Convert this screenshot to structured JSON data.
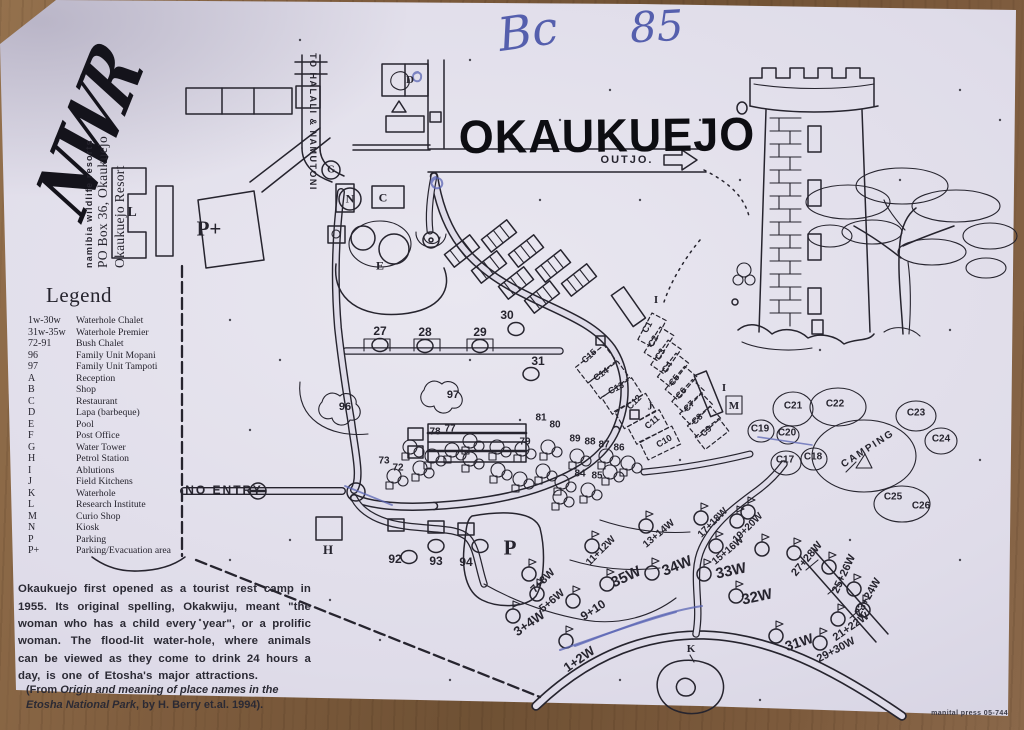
{
  "annotations": {
    "code_left": "Bc",
    "code_right": "85"
  },
  "header": {
    "title": "OKAUKUEJO"
  },
  "branding": {
    "logo": "NWR",
    "org": "namibia wildlife resorts",
    "address": "PO Box 36, Okaukuejo",
    "resort": "Okaukuejo Resort"
  },
  "legend": {
    "title": "Legend",
    "items": [
      {
        "key": "1w-30w",
        "label": "Waterhole Chalet"
      },
      {
        "key": "31w-35w",
        "label": "Waterhole Premier"
      },
      {
        "key": "72-91",
        "label": "Bush Chalet"
      },
      {
        "key": "96",
        "label": "Family Unit Mopani"
      },
      {
        "key": "97",
        "label": "Family Unit Tampoti"
      },
      {
        "key": "A",
        "label": "Reception"
      },
      {
        "key": "B",
        "label": "Shop"
      },
      {
        "key": "C",
        "label": "Restaurant"
      },
      {
        "key": "D",
        "label": "Lapa (barbeque)"
      },
      {
        "key": "E",
        "label": "Pool"
      },
      {
        "key": "F",
        "label": "Post Office"
      },
      {
        "key": "G",
        "label": "Water Tower"
      },
      {
        "key": "H",
        "label": "Petrol Station"
      },
      {
        "key": "I",
        "label": "Ablutions"
      },
      {
        "key": "J",
        "label": "Field Kitchens"
      },
      {
        "key": "K",
        "label": "Waterhole"
      },
      {
        "key": "L",
        "label": "Research Institute"
      },
      {
        "key": "M",
        "label": "Curio Shop"
      },
      {
        "key": "N",
        "label": "Kiosk"
      },
      {
        "key": "P",
        "label": "Parking"
      },
      {
        "key": "P+",
        "label": "Parking/Evacuation area"
      }
    ]
  },
  "map": {
    "outjo_label": "OUTJO.",
    "halali_label": "TO HALALI & NAMUTONI",
    "no_entry_label": "NO ENTRY",
    "labels": [
      {
        "t": "L",
        "x": 132,
        "y": 213,
        "s": 14,
        "f": "ser"
      },
      {
        "t": "P+",
        "x": 209,
        "y": 229,
        "s": 21,
        "f": "ser"
      },
      {
        "t": "N",
        "x": 350,
        "y": 199,
        "s": 12,
        "f": "ser",
        "ring": 11
      },
      {
        "t": "C",
        "x": 383,
        "y": 198,
        "s": 12,
        "f": "ser"
      },
      {
        "t": "E",
        "x": 380,
        "y": 266,
        "s": 12,
        "f": "ser"
      },
      {
        "t": "D",
        "x": 410,
        "y": 80,
        "s": 11,
        "f": "ser"
      },
      {
        "t": "G",
        "x": 331,
        "y": 170,
        "s": 10,
        "f": "ser",
        "ring": 9
      },
      {
        "t": "H",
        "x": 328,
        "y": 550,
        "s": 13,
        "f": "ser"
      },
      {
        "t": "P",
        "x": 510,
        "y": 548,
        "s": 21,
        "f": "ser"
      },
      {
        "t": "K",
        "x": 691,
        "y": 649,
        "s": 11,
        "f": "ser"
      },
      {
        "t": "M",
        "x": 734,
        "y": 406,
        "s": 11,
        "f": "ser"
      },
      {
        "t": "I",
        "x": 656,
        "y": 300,
        "s": 11,
        "f": "ser"
      },
      {
        "t": "I",
        "x": 724,
        "y": 388,
        "s": 11,
        "f": "ser"
      },
      {
        "t": "J",
        "x": 650,
        "y": 407,
        "s": 10,
        "f": "ser"
      },
      {
        "t": "27",
        "x": 380,
        "y": 331,
        "s": 12,
        "dot": [
          0,
          14
        ]
      },
      {
        "t": "28",
        "x": 425,
        "y": 332,
        "s": 12,
        "dot": [
          0,
          14
        ]
      },
      {
        "t": "29",
        "x": 480,
        "y": 332,
        "s": 12,
        "dot": [
          0,
          14
        ]
      },
      {
        "t": "30",
        "x": 507,
        "y": 315,
        "s": 12,
        "dot": [
          9,
          14
        ]
      },
      {
        "t": "31",
        "x": 538,
        "y": 361,
        "s": 12,
        "dot": [
          -7,
          13
        ]
      },
      {
        "t": "96",
        "x": 345,
        "y": 407,
        "s": 11
      },
      {
        "t": "97",
        "x": 453,
        "y": 395,
        "s": 11
      },
      {
        "t": "72",
        "x": 398,
        "y": 468,
        "s": 10
      },
      {
        "t": "73",
        "x": 384,
        "y": 461,
        "s": 10
      },
      {
        "t": "77",
        "x": 450,
        "y": 429,
        "s": 10
      },
      {
        "t": "78",
        "x": 435,
        "y": 432,
        "s": 10
      },
      {
        "t": "79",
        "x": 525,
        "y": 442,
        "s": 10
      },
      {
        "t": "80",
        "x": 555,
        "y": 425,
        "s": 10
      },
      {
        "t": "81",
        "x": 541,
        "y": 418,
        "s": 10
      },
      {
        "t": "84",
        "x": 580,
        "y": 474,
        "s": 10
      },
      {
        "t": "85",
        "x": 597,
        "y": 476,
        "s": 10
      },
      {
        "t": "86",
        "x": 619,
        "y": 448,
        "s": 10
      },
      {
        "t": "87",
        "x": 604,
        "y": 445,
        "s": 10
      },
      {
        "t": "88",
        "x": 590,
        "y": 442,
        "s": 10
      },
      {
        "t": "89",
        "x": 575,
        "y": 439,
        "s": 10
      },
      {
        "t": "92",
        "x": 395,
        "y": 559,
        "s": 12,
        "dot": [
          14,
          -2
        ]
      },
      {
        "t": "93",
        "x": 436,
        "y": 561,
        "s": 12,
        "dot": [
          0,
          -15
        ]
      },
      {
        "t": "94",
        "x": 466,
        "y": 562,
        "s": 12,
        "dot": [
          14,
          -16
        ]
      },
      {
        "t": "C1",
        "x": 647,
        "y": 327,
        "s": 9,
        "r": -60
      },
      {
        "t": "C2",
        "x": 653,
        "y": 341,
        "s": 9,
        "r": -60
      },
      {
        "t": "C3",
        "x": 660,
        "y": 354,
        "s": 9,
        "r": -58
      },
      {
        "t": "C4",
        "x": 667,
        "y": 367,
        "s": 9,
        "r": -55
      },
      {
        "t": "C5",
        "x": 674,
        "y": 380,
        "s": 9,
        "r": -52
      },
      {
        "t": "C6",
        "x": 681,
        "y": 393,
        "s": 9,
        "r": -49
      },
      {
        "t": "C7",
        "x": 689,
        "y": 406,
        "s": 9,
        "r": -46
      },
      {
        "t": "C8",
        "x": 697,
        "y": 419,
        "s": 9,
        "r": -44
      },
      {
        "t": "C9",
        "x": 706,
        "y": 431,
        "s": 9,
        "r": -42
      },
      {
        "t": "C10",
        "x": 664,
        "y": 441,
        "s": 9,
        "r": -30
      },
      {
        "t": "C11",
        "x": 652,
        "y": 422,
        "s": 9,
        "r": -40
      },
      {
        "t": "C12",
        "x": 634,
        "y": 402,
        "s": 9,
        "r": -45
      },
      {
        "t": "C13",
        "x": 616,
        "y": 388,
        "s": 9,
        "r": -28
      },
      {
        "t": "C14",
        "x": 601,
        "y": 374,
        "s": 9,
        "r": -35
      },
      {
        "t": "C15",
        "x": 589,
        "y": 356,
        "s": 9,
        "r": -42
      },
      {
        "t": "C17",
        "x": 785,
        "y": 460,
        "s": 10
      },
      {
        "t": "C18",
        "x": 813,
        "y": 457,
        "s": 10
      },
      {
        "t": "C19",
        "x": 760,
        "y": 429,
        "s": 10
      },
      {
        "t": "C20",
        "x": 787,
        "y": 433,
        "s": 10
      },
      {
        "t": "C21",
        "x": 793,
        "y": 406,
        "s": 10
      },
      {
        "t": "C22",
        "x": 835,
        "y": 404,
        "s": 10
      },
      {
        "t": "C23",
        "x": 916,
        "y": 413,
        "s": 10
      },
      {
        "t": "C24",
        "x": 941,
        "y": 439,
        "s": 10
      },
      {
        "t": "C25",
        "x": 893,
        "y": 497,
        "s": 10
      },
      {
        "t": "C26",
        "x": 921,
        "y": 506,
        "s": 10
      },
      {
        "t": "CAMPING",
        "x": 868,
        "y": 449,
        "s": 10,
        "r": -33,
        "sp": 2
      },
      {
        "t": "35W",
        "x": 626,
        "y": 577,
        "s": 15,
        "r": -25
      },
      {
        "t": "34W",
        "x": 677,
        "y": 566,
        "s": 15,
        "r": -22
      },
      {
        "t": "33W",
        "x": 731,
        "y": 571,
        "s": 15,
        "r": -12
      },
      {
        "t": "32W",
        "x": 757,
        "y": 597,
        "s": 15,
        "r": -12
      },
      {
        "t": "31W",
        "x": 799,
        "y": 642,
        "s": 14,
        "r": -18
      },
      {
        "t": "1+2W",
        "x": 579,
        "y": 659,
        "s": 13,
        "r": -35
      },
      {
        "t": "3+4W",
        "x": 529,
        "y": 623,
        "s": 13,
        "r": -35
      },
      {
        "t": "5+6W",
        "x": 552,
        "y": 601,
        "s": 11,
        "r": -40
      },
      {
        "t": "7+8W",
        "x": 543,
        "y": 581,
        "s": 11,
        "r": -45
      },
      {
        "t": "9+10",
        "x": 593,
        "y": 610,
        "s": 12,
        "r": -33
      },
      {
        "t": "11+12W",
        "x": 601,
        "y": 551,
        "s": 10,
        "r": -45
      },
      {
        "t": "13+14W",
        "x": 659,
        "y": 534,
        "s": 10,
        "r": -40
      },
      {
        "t": "15+16W",
        "x": 728,
        "y": 551,
        "s": 10,
        "r": -40
      },
      {
        "t": "17+18W",
        "x": 713,
        "y": 523,
        "s": 10,
        "r": -45
      },
      {
        "t": "19+20W",
        "x": 748,
        "y": 528,
        "s": 10,
        "r": -45
      },
      {
        "t": "21+22W",
        "x": 851,
        "y": 627,
        "s": 11,
        "r": -35
      },
      {
        "t": "23+24W",
        "x": 868,
        "y": 597,
        "s": 11,
        "r": -60
      },
      {
        "t": "25+26W",
        "x": 844,
        "y": 574,
        "s": 11,
        "r": -65
      },
      {
        "t": "27+28W",
        "x": 807,
        "y": 559,
        "s": 11,
        "r": -50
      },
      {
        "t": "29+30W",
        "x": 836,
        "y": 650,
        "s": 11,
        "r": -28
      }
    ]
  },
  "description": {
    "paragraph": "Okaukuejo first opened as a tourist rest camp in 1955. Its original spelling, Okakwiju, meant \"the woman who has a child every year\", or a prolific woman. The flood-lit water-hole, where animals can be viewed as they come to drink 24 hours a day, is one of Etosha's major attractions.",
    "citation_prefix": "(From ",
    "citation_title": "Origin and meaning of place names in the Etosha National Park",
    "citation_suffix": ", by H. Berry et.al. 1994)."
  },
  "footer": {
    "printer_note": "manital press 05-744"
  },
  "colors": {
    "ink": "#26242e",
    "blue_ink": "#4a55a8",
    "paper": "#dfdce9",
    "wood": "#7b5a39"
  }
}
